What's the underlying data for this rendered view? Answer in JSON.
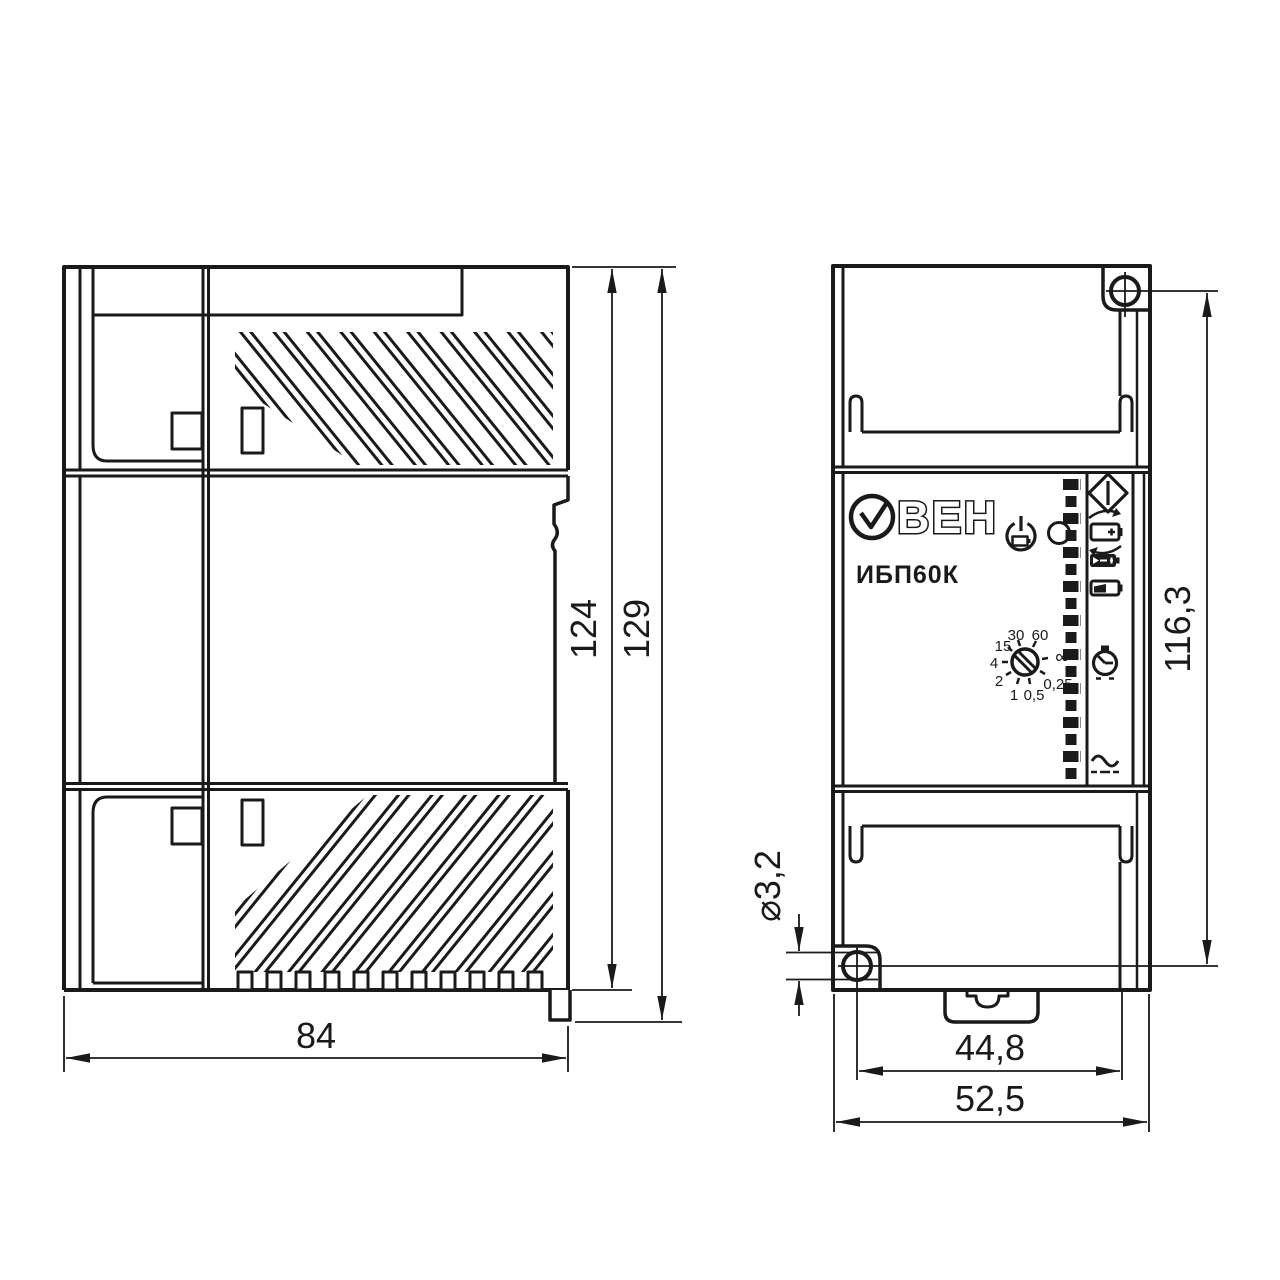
{
  "colors": {
    "ink": "#1a1a1a",
    "paper": "#ffffff"
  },
  "side_view": {
    "dims": {
      "width": "84",
      "body_height": "124",
      "total_height": "129"
    }
  },
  "front_view": {
    "brand_name": "ОВЕН",
    "brand_text": "ВЕН",
    "model": "ИБП60К",
    "dial_labels": {
      "d30": "30",
      "d60": "60",
      "inf": "∞",
      "d025": "0,25",
      "d05": "0,5",
      "d1": "1",
      "d2": "2",
      "d4": "4",
      "d15": "15"
    },
    "dims": {
      "height": "116,3",
      "hole_dia": "⌀3,2",
      "inner_width": "44,8",
      "total_width": "52,5"
    },
    "icons": [
      "standby-battery-icon",
      "led-indicator-icon",
      "diamond-output-icon",
      "battery-cycle-icon",
      "battery-charge-icon",
      "battery-level-icon",
      "timer-icon",
      "ac-wave-icon",
      "screw-hole-icon",
      "din-latch"
    ]
  }
}
